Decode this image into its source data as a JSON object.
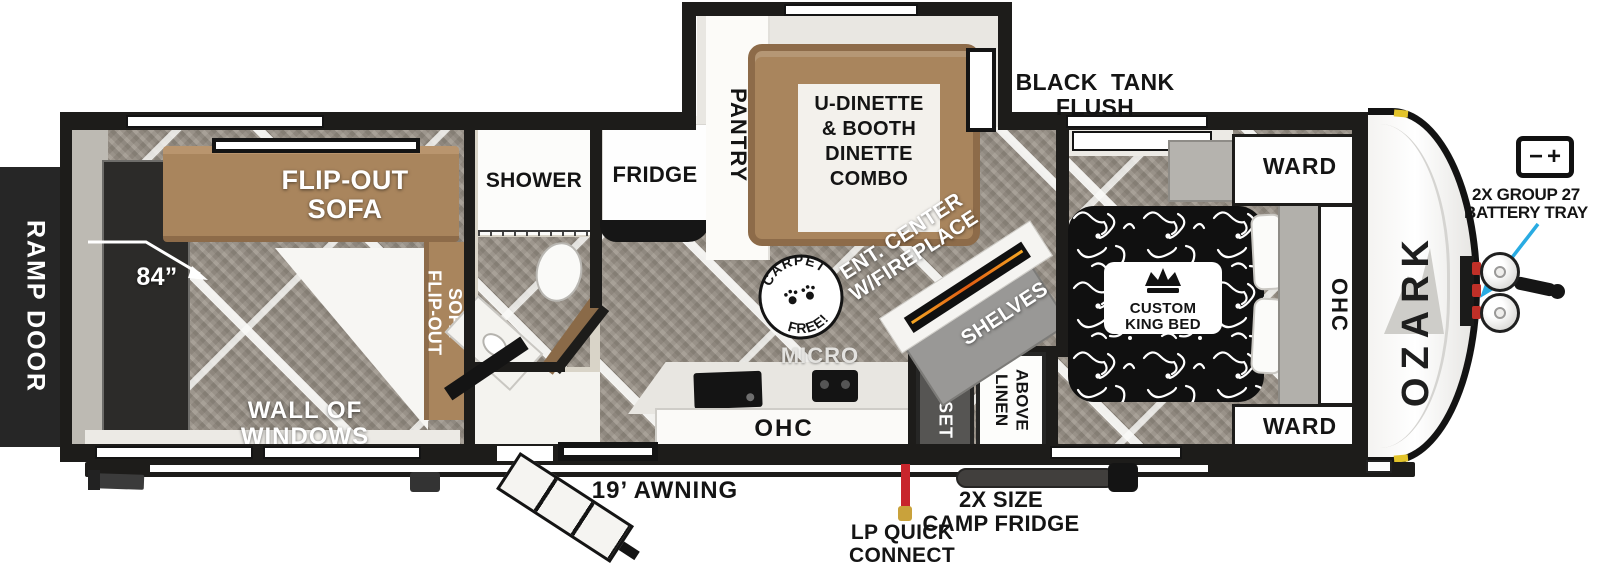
{
  "plan": {
    "brand": "OZARK",
    "ramp_door": "RAMP DOOR",
    "dimension_84": "84”",
    "garage": {
      "sofa_top": [
        "FLIP-OUT",
        "SOFA"
      ],
      "sofa_side": [
        "FLIP-OUT",
        "SOFA"
      ],
      "wall_of_windows": "WALL OF WINDOWS"
    },
    "bath": {
      "shower": "SHOWER"
    },
    "kitchen": {
      "fridge": "FRIDGE",
      "pantry": "PANTRY",
      "micro": "MICRO",
      "ohc": "OHC"
    },
    "dinette": {
      "label": [
        "U-DINETTE",
        "& BOOTH",
        "DINETTE",
        "COMBO"
      ]
    },
    "living": {
      "ent_center": [
        "ENT. CENTER",
        "W/FIREPLACE"
      ],
      "shelves": "SHELVES",
      "carpet_free": [
        "CARPET",
        "FREE!"
      ]
    },
    "bedroom": {
      "bed": [
        "CUSTOM",
        "KING BED"
      ],
      "ward_top": "WARD",
      "ward_bottom": "WARD",
      "ohc": "OHC",
      "closet": "CLOSET",
      "linen": [
        "LINEN",
        "ABOVE"
      ]
    },
    "callouts": {
      "black_tank_flush": [
        "BLACK  TANK",
        "FLUSH"
      ],
      "battery": [
        "2X GROUP 27",
        "BATTERY TRAY"
      ],
      "awning": "19’ AWNING",
      "lp_quick_connect": [
        "LP QUICK",
        "CONNECT"
      ],
      "camp_fridge": [
        "2X SIZE",
        "CAMP FRIDGE"
      ]
    },
    "colors": {
      "wall": "#1d1c1a",
      "floor": "#9e978d",
      "sofa": "#a9855d",
      "bed": "#101010",
      "accent_arrow": "#29abe2",
      "lp_red": "#c8252c"
    }
  }
}
